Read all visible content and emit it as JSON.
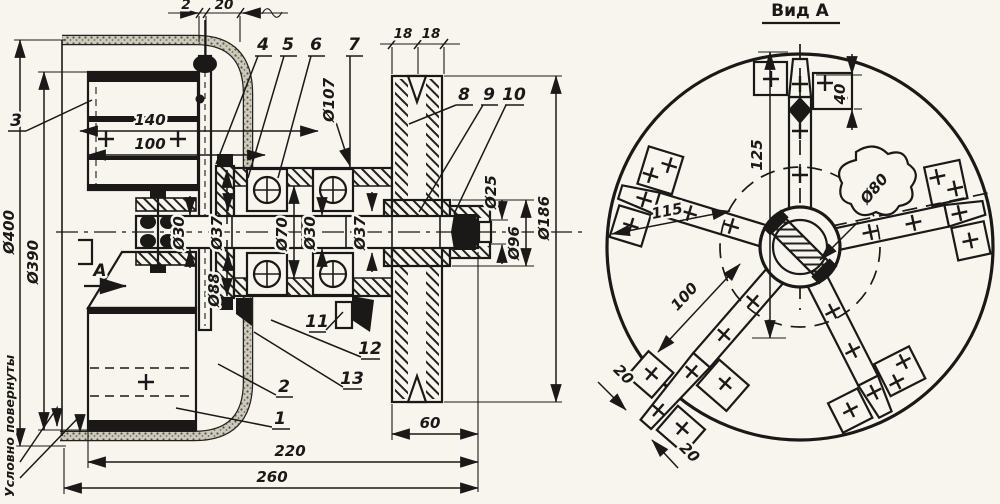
{
  "colors": {
    "ink": "#1b1917",
    "paper": "#f7f5ee"
  },
  "section": {
    "dims": {
      "d2": "2",
      "d20": "20",
      "d18a": "18",
      "d18b": "18",
      "d140": "140",
      "d100": "100",
      "d60": "60",
      "d220": "220",
      "d260": "260",
      "dia400": "Ø400",
      "dia390": "Ø390",
      "dia30a": "Ø30",
      "dia37a": "Ø37",
      "dia88": "Ø88",
      "dia70": "Ø70",
      "dia30b": "Ø30",
      "dia37b": "Ø37",
      "dia107": "Ø107",
      "dia25": "Ø25",
      "dia96": "Ø96",
      "dia186": "Ø186"
    },
    "note_rotated": "Условно повернуты",
    "view_arrow_label": "А"
  },
  "parts": {
    "p1": "1",
    "p2": "2",
    "p3": "3",
    "p4": "4",
    "p5": "5",
    "p6": "6",
    "p7": "7",
    "p8": "8",
    "p9": "9",
    "p10": "10",
    "p11": "11",
    "p12": "12",
    "p13": "13"
  },
  "view_a": {
    "title": "Вид А",
    "d125": "125",
    "d40": "40",
    "dia80": "Ø80",
    "d115": "115",
    "d100": "100",
    "d20a": "20",
    "d20b": "20"
  }
}
